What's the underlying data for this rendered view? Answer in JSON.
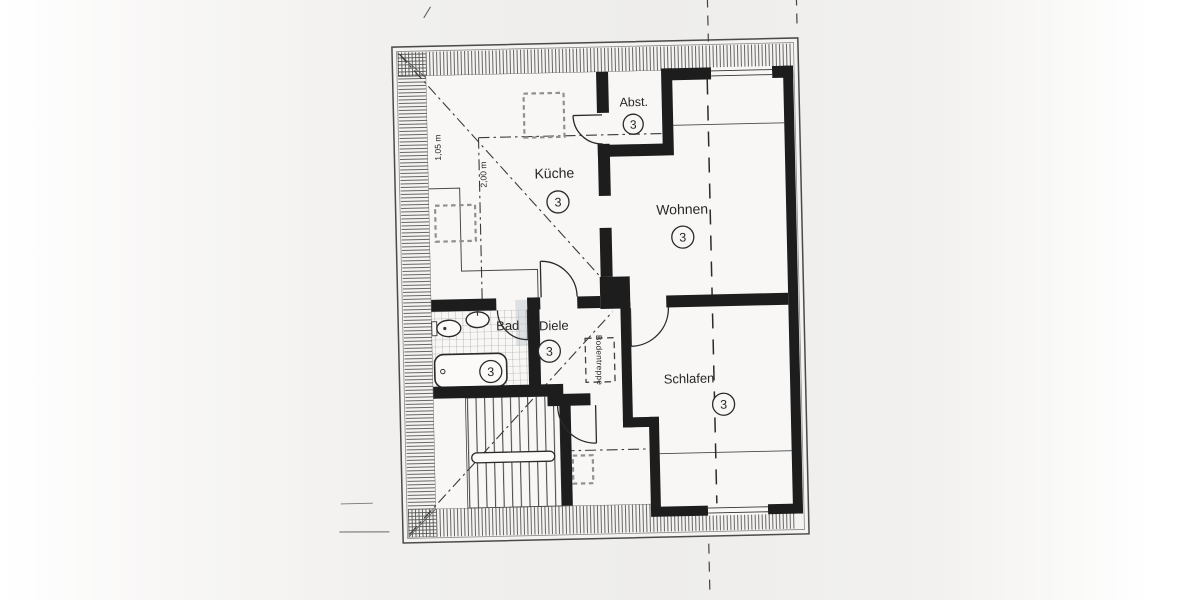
{
  "plan": {
    "type": "floor-plan",
    "rooms": [
      {
        "key": "kueche",
        "label": "Küche",
        "number": "3"
      },
      {
        "key": "abst",
        "label": "Abst.",
        "number": "3"
      },
      {
        "key": "wohnen",
        "label": "Wohnen",
        "number": "3"
      },
      {
        "key": "bad",
        "label": "Bad",
        "number": "3"
      },
      {
        "key": "diele",
        "label": "Diele",
        "number": "3"
      },
      {
        "key": "schlafen",
        "label": "Schlafen",
        "number": "3"
      }
    ],
    "annotations": {
      "attic_stairs": "Bodentreppe",
      "dim_knee_wall": "1,05 m",
      "dim_headroom": "2,00 m"
    },
    "colors": {
      "paper": "#f2f1ef",
      "line": "#2a2a2a",
      "wall": "#1d1d1d",
      "hatch": "#4d4d4d",
      "tile": "#999999",
      "smudge": "#b7c1c9"
    }
  }
}
